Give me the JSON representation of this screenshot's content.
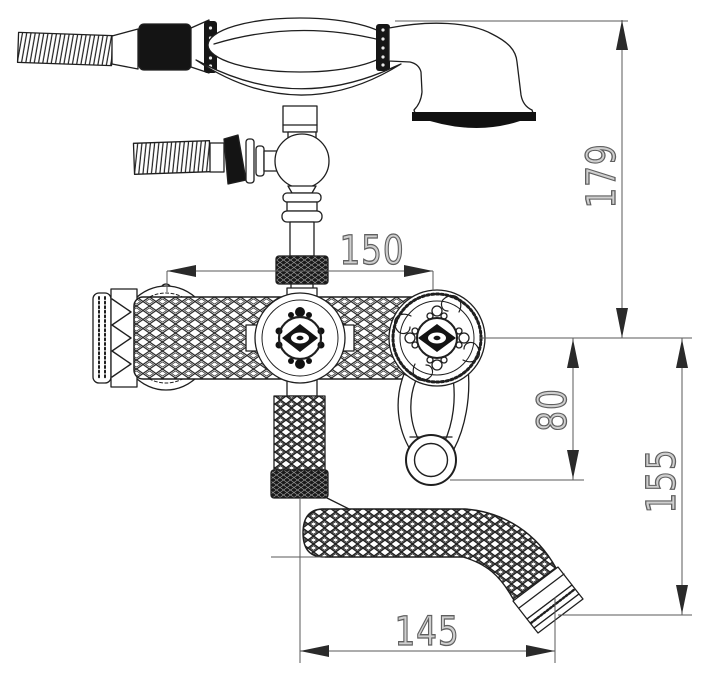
{
  "drawing": {
    "subject": "Wall-mount bathtub mixer faucet with telephone-style handheld shower",
    "style": "black line-art technical dimension drawing on white"
  },
  "dimensions": [
    {
      "value": "179",
      "orientation": "vertical",
      "measures": "spray-head top down to handwheel centerline"
    },
    {
      "value": "150",
      "orientation": "horizontal",
      "measures": "spacing between left handle and right handwheel centers"
    },
    {
      "value": "80",
      "orientation": "vertical",
      "measures": "handwheel centerline down to lever ring bottom"
    },
    {
      "value": "155",
      "orientation": "vertical",
      "measures": "handwheel centerline down to spout outlet"
    },
    {
      "value": "145",
      "orientation": "horizontal",
      "measures": "riser centerline to spout outlet reach"
    }
  ],
  "colors": {
    "line": "#1f1f1f",
    "dimension_line": "#5a5a5a",
    "arrow": "#2a2a2a",
    "dimension_text_stroke": "#5f5f5f",
    "background": "#ffffff"
  }
}
